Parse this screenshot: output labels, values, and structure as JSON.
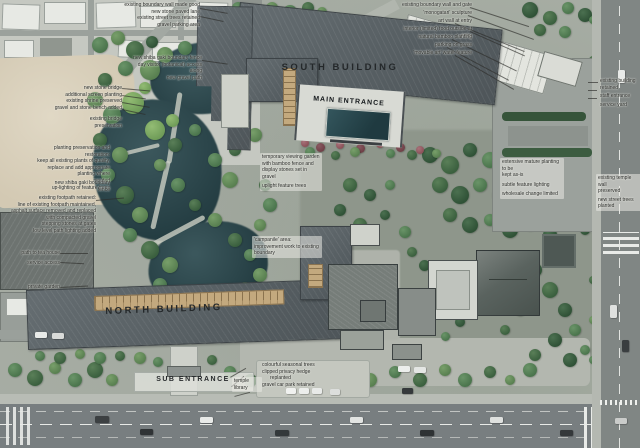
{
  "page": {
    "title": "Landscape masterplan over aerial photograph"
  },
  "labels": {
    "south_building": "SOUTH BUILDING",
    "main_entrance": "MAIN ENTRANCE",
    "north_building": "NORTH BUILDING",
    "sub_entrance": "SUB ENTRANCE",
    "temple_library": "temple library"
  },
  "annotations": {
    "top_left": [
      "existing boundary wall made good",
      "new stone paved lane",
      "existing street trees retained",
      "gravel parking area"
    ],
    "pond_access": [
      "new shiba gaki boundary fence",
      "day visitor (botanical) access along",
      "new gravel path"
    ],
    "bridge_group": [
      "new stone bridge",
      "additional screen planting",
      "existing shrine preserved",
      "gravel and stone bench added"
    ],
    "bridge_preservation": "existing bridge preservation",
    "planting_group": [
      "planting preservation and restoration:",
      "keep all existing plants of quality,",
      "replace and add appropriate planting where",
      "needed",
      "up-lighting of feature trees"
    ],
    "boundary_fence": "new shiba gaki boundary fence",
    "footpath_group": [
      "existing footpath retained:",
      "line of existing footpath maintained,",
      "asphalt surface removed and replaced",
      "with compacted gravel",
      "stepping stones at gates",
      "low level path lighting added"
    ],
    "left_small": [
      "path to tea house",
      "service access",
      "private garden"
    ],
    "viewing_garden": [
      "temporary viewing garden",
      "with bamboo fence and",
      "display stones set in",
      "gravel",
      "uplight feature trees"
    ],
    "campanile": [
      "'campanile' area:",
      "improvement work to existing",
      "boundary"
    ],
    "mature_planting": [
      "extensive mature planting to be",
      "kept as-is",
      "subtle feature lighting",
      "wholesale change limited"
    ],
    "temple_wall": [
      "existing temple wall",
      "preserved",
      "new street trees planted"
    ],
    "top_right": [
      "existing boundary wall and gate",
      "'monogatari' sculpture",
      "art wall at entry",
      "interior (limited) food outside at entry",
      "natural bamboo planting",
      "parking on grass",
      "'movable art' water feature"
    ],
    "right_edge": [
      "existing building retained",
      "staff entrance",
      "service yard"
    ],
    "bottom_center": [
      "colourful seasonal trees",
      "clipped privacy hedge",
      "replanted",
      "gravel car park retained"
    ]
  },
  "colors": {
    "new_roof": "#5d6569",
    "pond_water": "#2c4348",
    "room_strip_tan": "#c3a97e",
    "entrance_panel_teal": "#2b4d54",
    "asphalt": "#7a8082"
  }
}
